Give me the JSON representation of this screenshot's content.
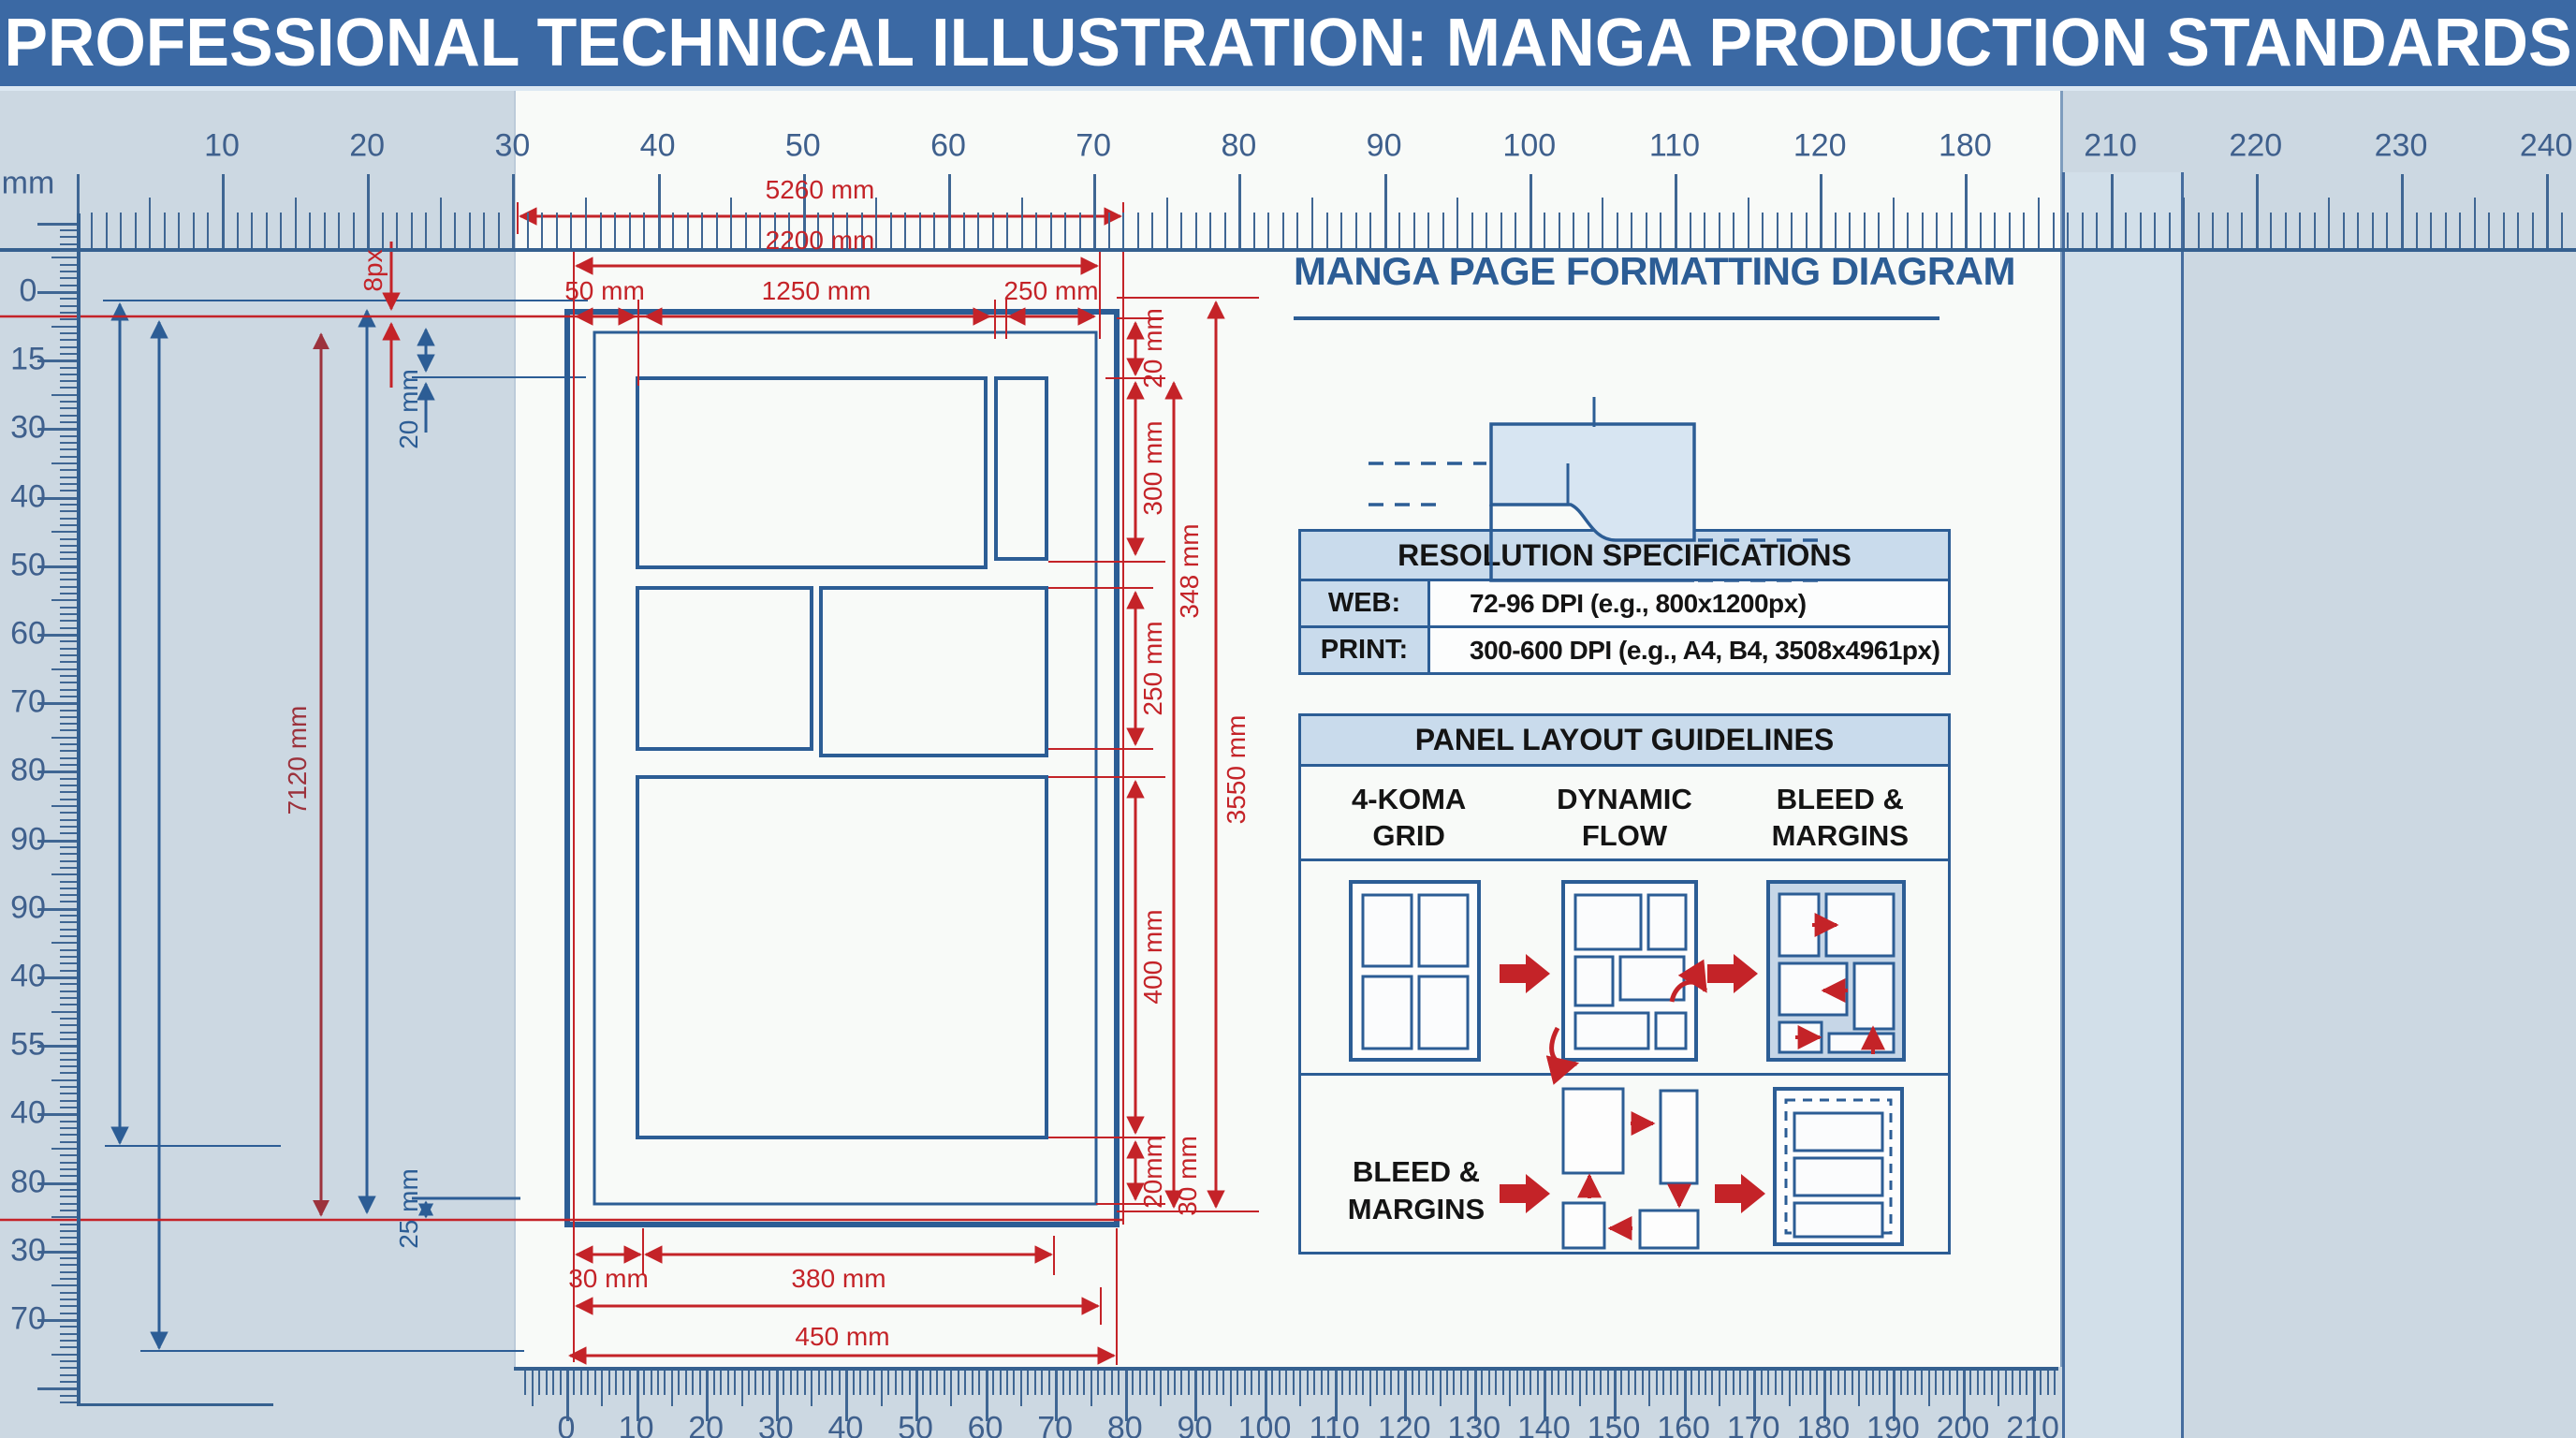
{
  "header": {
    "title": "PROFESSIONAL TECHNICAL ILLUSTRATION: MANGA PRODUCTION STANDARDS"
  },
  "rulers": {
    "unit_label": "mm",
    "top_labels": [
      "10",
      "20",
      "30",
      "40",
      "50",
      "60",
      "70",
      "80",
      "90",
      "100",
      "110",
      "120",
      "180",
      "210",
      "220",
      "230",
      "240"
    ],
    "left_labels": [
      "0",
      "15",
      "30",
      "40",
      "50",
      "60",
      "70",
      "80",
      "90",
      "90",
      "40",
      "55",
      "40",
      "80",
      "30",
      "70"
    ],
    "bottom_labels": [
      "0",
      "10",
      "20",
      "30",
      "40",
      "50",
      "60",
      "70",
      "80",
      "90",
      "100",
      "110",
      "120",
      "130",
      "140",
      "150",
      "160",
      "170",
      "180",
      "190",
      "200",
      "210"
    ]
  },
  "drawing": {
    "dim_overall_width": "5260 mm",
    "dim_trim_width": "2200 mm",
    "dim_margin_small": "50 mm",
    "dim_panel_row_width": "1250 mm",
    "dim_column_width": "250 mm",
    "dim_bleed_px": "8px",
    "dim_top_margin": "20 mm",
    "dim_page_height": "7120 mm",
    "dim_bottom_inner_margin": "25 mm",
    "dim_right_top_gap": "20 mm",
    "dim_panel1_height": "300 mm",
    "dim_content_height": "348 mm",
    "dim_panel2_height": "250 mm",
    "dim_panel3_height": "400 mm",
    "dim_right_bottom_gap": "20mm",
    "dim_outer_margin": "30 mm",
    "dim_total_height": "3550 mm",
    "dim_bottom_margin": "30 mm",
    "dim_bottom_panel_width": "380 mm",
    "dim_trim_bottom_width": "450 mm"
  },
  "info": {
    "title": "MANGA PAGE FORMATTING DIAGRAM",
    "resolution": {
      "header": "RESOLUTION SPECIFICATIONS",
      "rows": [
        {
          "label": "WEB:",
          "value": "72-96 DPI (e.g., 800x1200px)"
        },
        {
          "label": "PRINT:",
          "value": "300-600 DPI (e.g., A4, B4, 3508x4961px)"
        }
      ]
    },
    "guidelines": {
      "header": "PANEL LAYOUT GUIDELINES",
      "columns": [
        "4-KOMA GRID",
        "DYNAMIC FLOW",
        "BLEED & MARGINS"
      ],
      "row2_label": "BLEED & MARGINS"
    }
  },
  "colors": {
    "header_bg": "#3b69a4",
    "accent_blue": "#2c5d95",
    "dimension_red": "#c42328",
    "dim_dark_red": "#9c323c",
    "table_header_bg": "#c9dbec",
    "ruler_ink": "#3f6693"
  }
}
